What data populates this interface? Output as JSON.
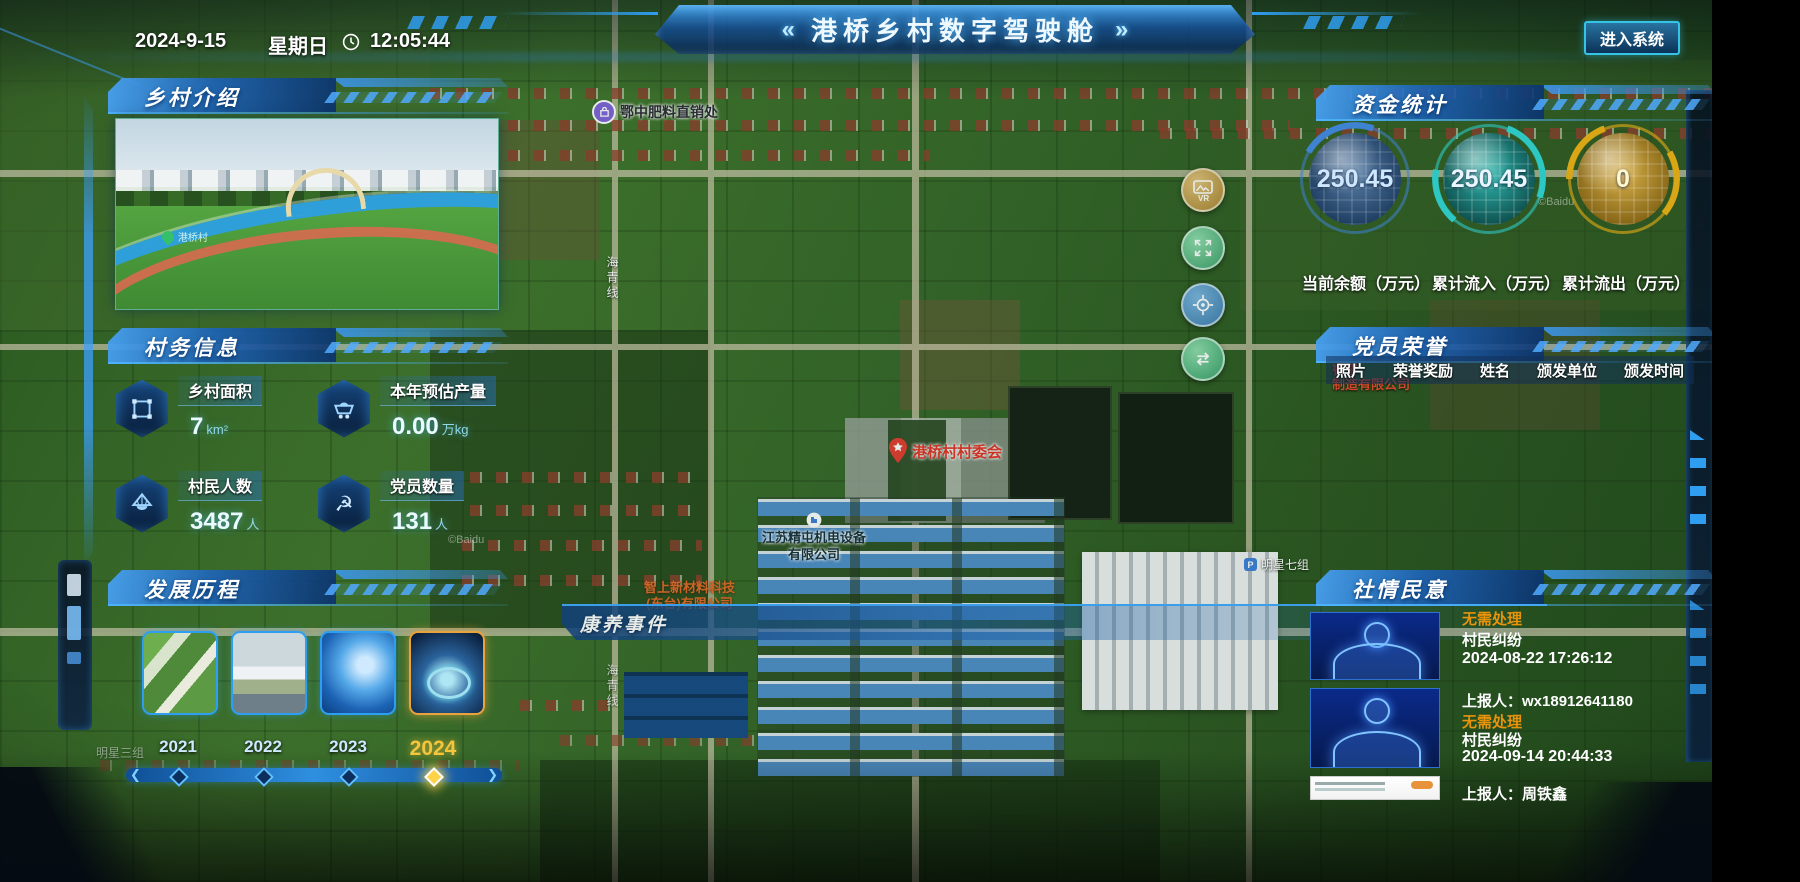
{
  "topbar": {
    "date": "2024-9-15",
    "weekday": "星期日",
    "time": "12:05:44",
    "title": "港桥乡村数字驾驶舱",
    "chevron_left": "«",
    "chevron_right": "»",
    "enter_system": "进入系统"
  },
  "panels": {
    "intro": {
      "title": "乡村介绍",
      "photo_caption": "港桥村"
    },
    "village_info": {
      "title": "村务信息",
      "stats": [
        {
          "icon": "area-outline-icon",
          "label": "乡村面积",
          "value": "7",
          "unit": "km²"
        },
        {
          "icon": "mine-cart-icon",
          "label": "本年预估产量",
          "value": "0.00",
          "unit": "万kg"
        },
        {
          "icon": "farmer-hat-icon",
          "label": "村民人数",
          "value": "3487",
          "unit": "人"
        },
        {
          "icon": "party-emblem-icon",
          "label": "党员数量",
          "value": "131",
          "unit": "人"
        }
      ]
    },
    "history": {
      "title": "发展历程",
      "active_year": "2024",
      "items": [
        {
          "year": "2021"
        },
        {
          "year": "2022"
        },
        {
          "year": "2023"
        },
        {
          "year": "2024"
        }
      ]
    },
    "funds": {
      "title": "资金统计",
      "gauges": [
        {
          "value": "250.45",
          "label": "当前余额（万元）",
          "accent": "#3e82d2"
        },
        {
          "value": "250.45",
          "label": "累计流入（万元）",
          "accent": "#2ec8c4"
        },
        {
          "value": "0",
          "label": "累计流出（万元）",
          "accent": "#d9a616"
        }
      ]
    },
    "honors": {
      "title": "党员荣誉",
      "columns": [
        "照片",
        "荣誉奖励",
        "姓名",
        "颁发单位",
        "颁发时间"
      ]
    },
    "sentiment": {
      "title": "社情民意",
      "status_color": "#e8930c",
      "items": [
        {
          "status": "无需处理",
          "category": "村民纠纷",
          "datetime": "2024-08-22 17:26:12",
          "reporter": "上报人：wx18912641180"
        },
        {
          "status": "无需处理",
          "category": "村民纠纷",
          "datetime": "2024-09-14 20:44:33",
          "reporter": "上报人：周铁鑫"
        }
      ]
    }
  },
  "map": {
    "event_banner": "康养事件",
    "watermark": "©Baidu",
    "pois": [
      {
        "name": "鄂中肥料直销处"
      },
      {
        "name": "港桥村村委会"
      },
      {
        "name": "江苏精屯机电设备",
        "name2": "有限公司"
      },
      {
        "name": "智上新材料科技",
        "name2": "(东台)有限公司"
      },
      {
        "name": "明星七组"
      },
      {
        "name": "明星三组"
      },
      {
        "name": "海青线"
      },
      {
        "name": "睿智",
        "name2": "制造有限公司"
      }
    ],
    "controls": [
      {
        "icon": "vr-panorama-icon",
        "label": "VR"
      },
      {
        "icon": "fullscreen-icon"
      },
      {
        "icon": "locate-icon"
      },
      {
        "icon": "switch-layers-icon"
      }
    ]
  }
}
